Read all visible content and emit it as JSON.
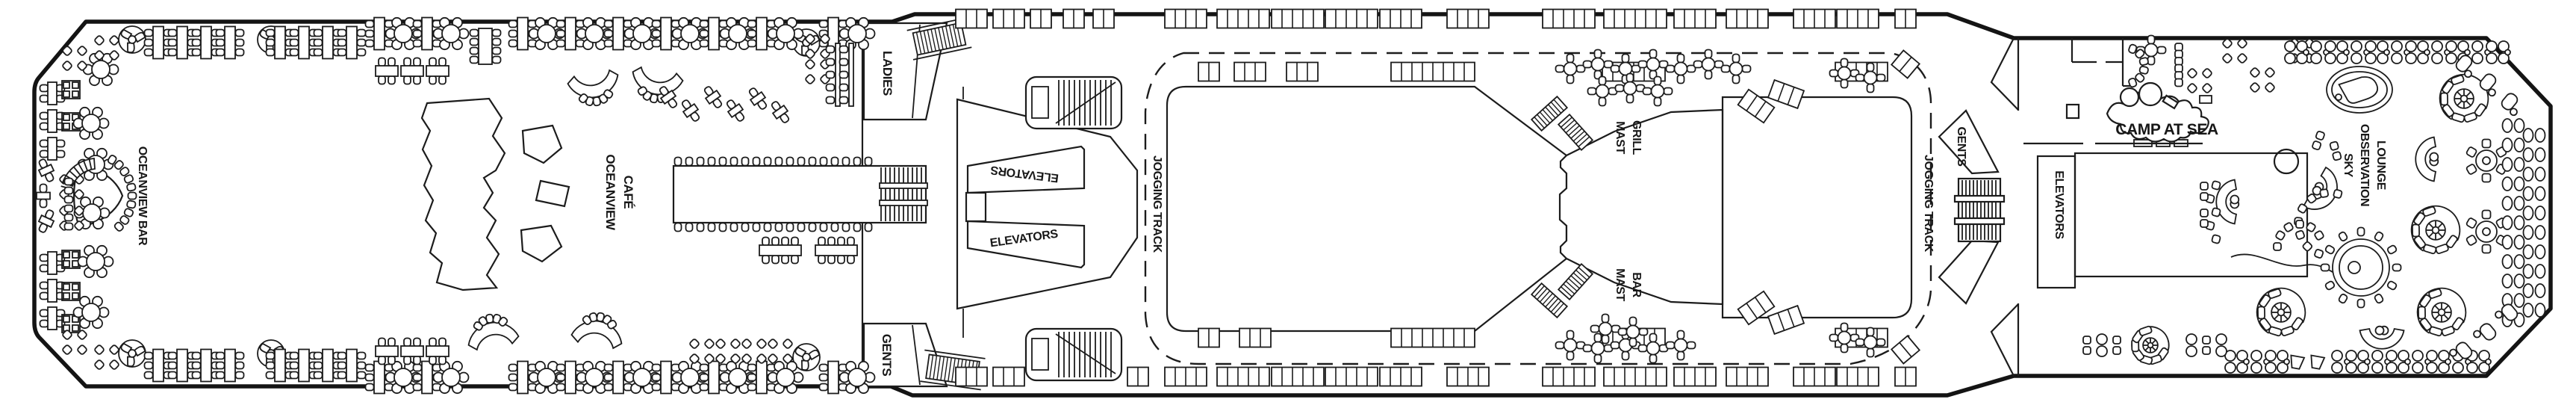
{
  "colors": {
    "ink": "#1c1c1c",
    "paper": "#ffffff"
  },
  "labels": {
    "oceanview_bar": "OCEANVIEW BAR",
    "oceanview_cafe": {
      "line1": "OCEANVIEW",
      "line2": "CAFÉ"
    },
    "ladies": "LADIES",
    "gents_forward": "GENTS",
    "elevators_forward_top": "ELEVATORS",
    "elevators_forward_bottom": "ELEVATORS",
    "jogging_track_forward": "JOGGING TRACK",
    "mast_grill": {
      "line1": "MAST",
      "line2": "GRILL"
    },
    "mast_bar": {
      "line1": "MAST",
      "line2": "BAR"
    },
    "jogging_track_aft": "JOGGING TRACK",
    "gents_aft": "GENTS",
    "elevators_aft": "ELEVATORS",
    "camp_at_sea": "CAMP AT SEA",
    "sky_observation_lounge": {
      "line1": "SKY",
      "line2": "OBSERVATION",
      "line3": "LOUNGE"
    }
  }
}
